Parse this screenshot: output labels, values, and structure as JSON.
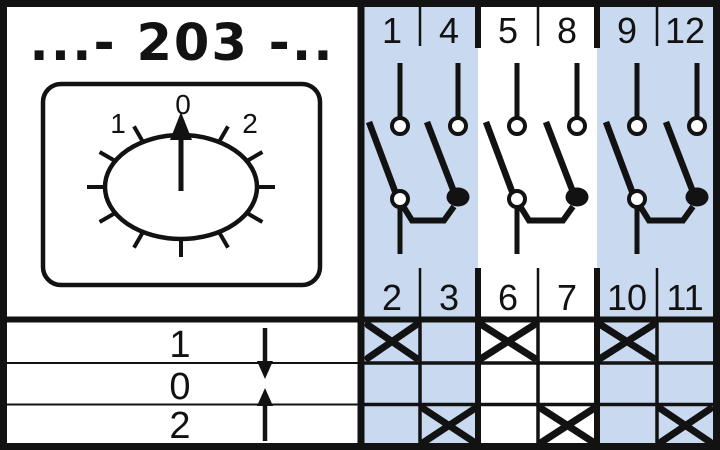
{
  "title": "...- 203 -..",
  "colors": {
    "highlight": "#c9d9ef",
    "ink": "#121212",
    "background": "#ffffff"
  },
  "dial": {
    "position_labels": [
      "1",
      "0",
      "2"
    ],
    "selected": "0"
  },
  "switch_positions": [
    {
      "label": "1",
      "arrow": "down"
    },
    {
      "label": "0",
      "arrow": ""
    },
    {
      "label": "2",
      "arrow": "up"
    }
  ],
  "contact_groups": [
    {
      "top_terminals": [
        "1",
        "4"
      ],
      "bottom_terminals": [
        "2",
        "3"
      ],
      "highlighted": true
    },
    {
      "top_terminals": [
        "5",
        "8"
      ],
      "bottom_terminals": [
        "6",
        "7"
      ],
      "highlighted": false
    },
    {
      "top_terminals": [
        "9",
        "12"
      ],
      "bottom_terminals": [
        "10",
        "11"
      ],
      "highlighted": true
    }
  ],
  "contact_table": {
    "rows": [
      {
        "position": "1",
        "closed": [
          true,
          false,
          true,
          false,
          true,
          false
        ]
      },
      {
        "position": "0",
        "closed": [
          false,
          false,
          false,
          false,
          false,
          false
        ]
      },
      {
        "position": "2",
        "closed": [
          false,
          true,
          false,
          true,
          false,
          true
        ]
      }
    ]
  }
}
